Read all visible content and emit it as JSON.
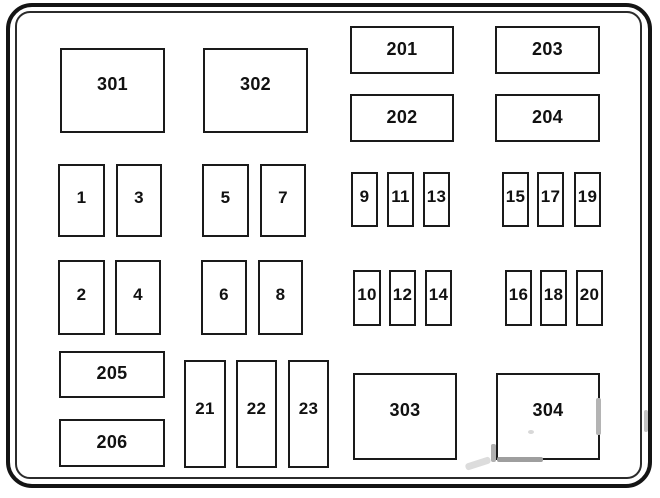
{
  "diagram": {
    "type": "fuse-box-layout",
    "background": "#ffffff",
    "line_color": "#1a1a1a",
    "boxes": [
      {
        "label": "301",
        "kind": "relay",
        "x": 60,
        "y": 48,
        "w": 105,
        "h": 85
      },
      {
        "label": "302",
        "kind": "relay",
        "x": 203,
        "y": 48,
        "w": 105,
        "h": 85
      },
      {
        "label": "201",
        "kind": "module",
        "x": 350,
        "y": 26,
        "w": 104,
        "h": 48
      },
      {
        "label": "203",
        "kind": "module",
        "x": 495,
        "y": 26,
        "w": 105,
        "h": 48
      },
      {
        "label": "202",
        "kind": "module",
        "x": 350,
        "y": 94,
        "w": 104,
        "h": 48
      },
      {
        "label": "204",
        "kind": "module",
        "x": 495,
        "y": 94,
        "w": 105,
        "h": 48
      },
      {
        "label": "1",
        "kind": "fuse-md",
        "x": 58,
        "y": 164,
        "w": 47,
        "h": 73
      },
      {
        "label": "3",
        "kind": "fuse-md",
        "x": 116,
        "y": 164,
        "w": 46,
        "h": 73
      },
      {
        "label": "5",
        "kind": "fuse-md",
        "x": 202,
        "y": 164,
        "w": 47,
        "h": 73
      },
      {
        "label": "7",
        "kind": "fuse-md",
        "x": 260,
        "y": 164,
        "w": 46,
        "h": 73
      },
      {
        "label": "9",
        "kind": "fuse-sm",
        "x": 351,
        "y": 172,
        "w": 27,
        "h": 55
      },
      {
        "label": "11",
        "kind": "fuse-sm",
        "x": 387,
        "y": 172,
        "w": 27,
        "h": 55
      },
      {
        "label": "13",
        "kind": "fuse-sm",
        "x": 423,
        "y": 172,
        "w": 27,
        "h": 55
      },
      {
        "label": "15",
        "kind": "fuse-sm",
        "x": 502,
        "y": 172,
        "w": 27,
        "h": 55
      },
      {
        "label": "17",
        "kind": "fuse-sm",
        "x": 537,
        "y": 172,
        "w": 27,
        "h": 55
      },
      {
        "label": "19",
        "kind": "fuse-sm",
        "x": 574,
        "y": 172,
        "w": 27,
        "h": 55
      },
      {
        "label": "2",
        "kind": "fuse-md",
        "x": 58,
        "y": 260,
        "w": 47,
        "h": 75
      },
      {
        "label": "4",
        "kind": "fuse-md",
        "x": 115,
        "y": 260,
        "w": 46,
        "h": 75
      },
      {
        "label": "6",
        "kind": "fuse-md",
        "x": 201,
        "y": 260,
        "w": 46,
        "h": 75
      },
      {
        "label": "8",
        "kind": "fuse-md",
        "x": 258,
        "y": 260,
        "w": 45,
        "h": 75
      },
      {
        "label": "10",
        "kind": "fuse-sm",
        "x": 353,
        "y": 270,
        "w": 28,
        "h": 56
      },
      {
        "label": "12",
        "kind": "fuse-sm",
        "x": 389,
        "y": 270,
        "w": 27,
        "h": 56
      },
      {
        "label": "14",
        "kind": "fuse-sm",
        "x": 425,
        "y": 270,
        "w": 27,
        "h": 56
      },
      {
        "label": "16",
        "kind": "fuse-sm",
        "x": 505,
        "y": 270,
        "w": 27,
        "h": 56
      },
      {
        "label": "18",
        "kind": "fuse-sm",
        "x": 540,
        "y": 270,
        "w": 27,
        "h": 56
      },
      {
        "label": "20",
        "kind": "fuse-sm",
        "x": 576,
        "y": 270,
        "w": 27,
        "h": 56
      },
      {
        "label": "205",
        "kind": "module",
        "x": 59,
        "y": 351,
        "w": 106,
        "h": 47
      },
      {
        "label": "206",
        "kind": "module",
        "x": 59,
        "y": 419,
        "w": 106,
        "h": 48
      },
      {
        "label": "21",
        "kind": "fuse-tall",
        "x": 184,
        "y": 360,
        "w": 42,
        "h": 108
      },
      {
        "label": "22",
        "kind": "fuse-tall",
        "x": 236,
        "y": 360,
        "w": 41,
        "h": 108
      },
      {
        "label": "23",
        "kind": "fuse-tall",
        "x": 288,
        "y": 360,
        "w": 41,
        "h": 108
      },
      {
        "label": "303",
        "kind": "relay",
        "x": 353,
        "y": 373,
        "w": 104,
        "h": 87
      },
      {
        "label": "304",
        "kind": "relay",
        "x": 496,
        "y": 373,
        "w": 104,
        "h": 87
      }
    ]
  }
}
